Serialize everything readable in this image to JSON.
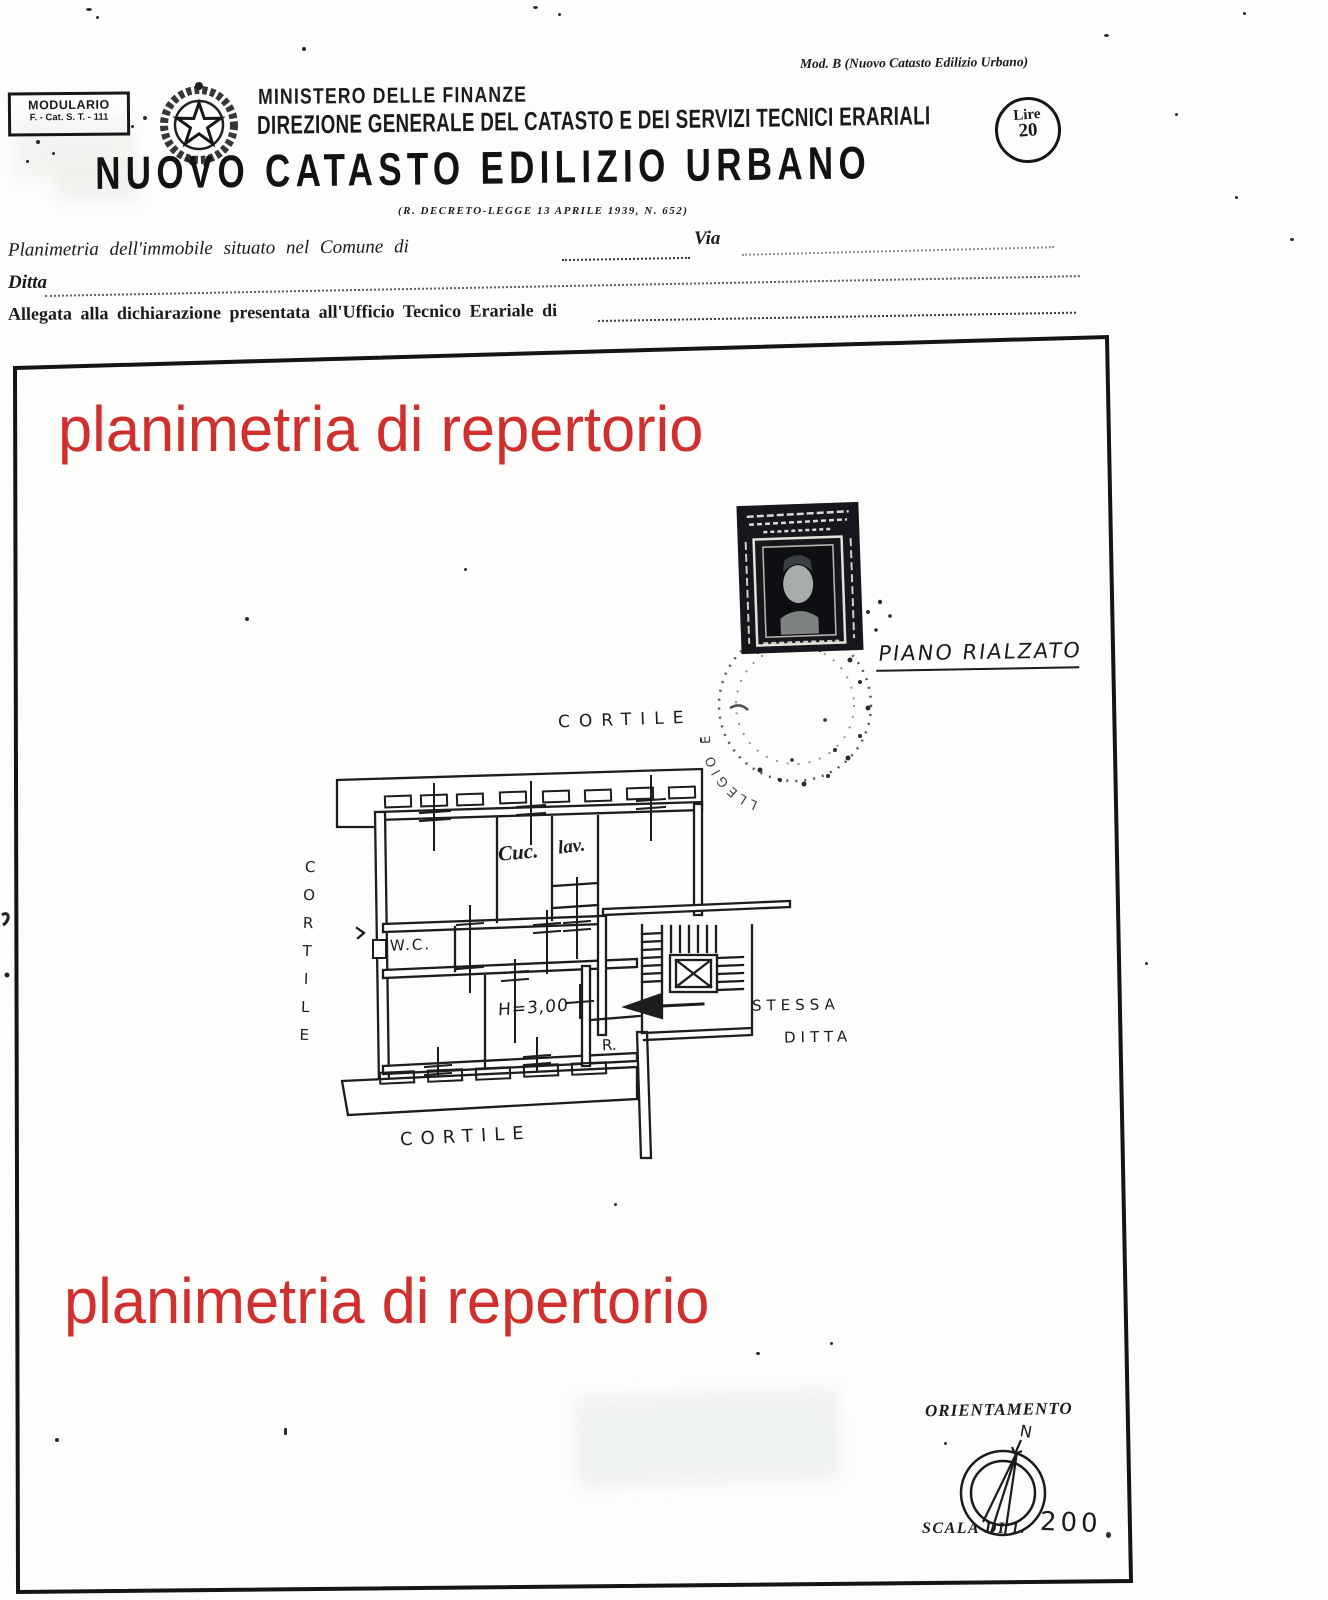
{
  "colors": {
    "ink": "#1b1b1b",
    "red_overlay": "#d0302d",
    "stamp_dark": "#15171c",
    "paper": "#fdfdfc"
  },
  "header": {
    "modulario_line1": "MODULARIO",
    "modulario_line2": "F. - Cat. S. T. - 111",
    "mod_b": "Mod. B (Nuovo Catasto Edilizio Urbano)",
    "ministry": "MINISTERO DELLE FINANZE",
    "direzione": "DIREZIONE GENERALE DEL CATASTO E DEI SERVIZI TECNICI ERARIALI",
    "title": "NUOVO CATASTO EDILIZIO URBANO",
    "decree": "(R. DECRETO-LEGGE 13 APRILE 1939, N. 652)",
    "lire_label": "Lire",
    "lire_value": "20"
  },
  "form": {
    "line1_label": "Planimetria dell'immobile situato nel Comune di",
    "via_label": "Via",
    "line2_label": "Ditta",
    "line3_label": "Allegata alla dichiarazione presentata all'Ufficio Tecnico Erariale di"
  },
  "overlay": {
    "watermark_top": "planimetria di repertorio",
    "watermark_bottom": "planimetria di repertorio"
  },
  "plan": {
    "floor_label": "PIANO RIALZATO",
    "cortile_top": "CORTILE",
    "cortile_left": "CORTILE",
    "cortile_bottom": "CORTILE",
    "room_kitchen": "Cuc.",
    "room_laundry": "lav.",
    "room_wc": "W.C.",
    "room_height": "H=3,00",
    "room_r": "R.",
    "adjacent_line1": "STESSA",
    "adjacent_line2": "DITTA",
    "postmark_text": "LLEGIO E"
  },
  "footer": {
    "orientation_label": "ORIENTAMENTO",
    "north_label": "N",
    "scale_label": "SCALA DI 1.",
    "scale_value": "200"
  }
}
